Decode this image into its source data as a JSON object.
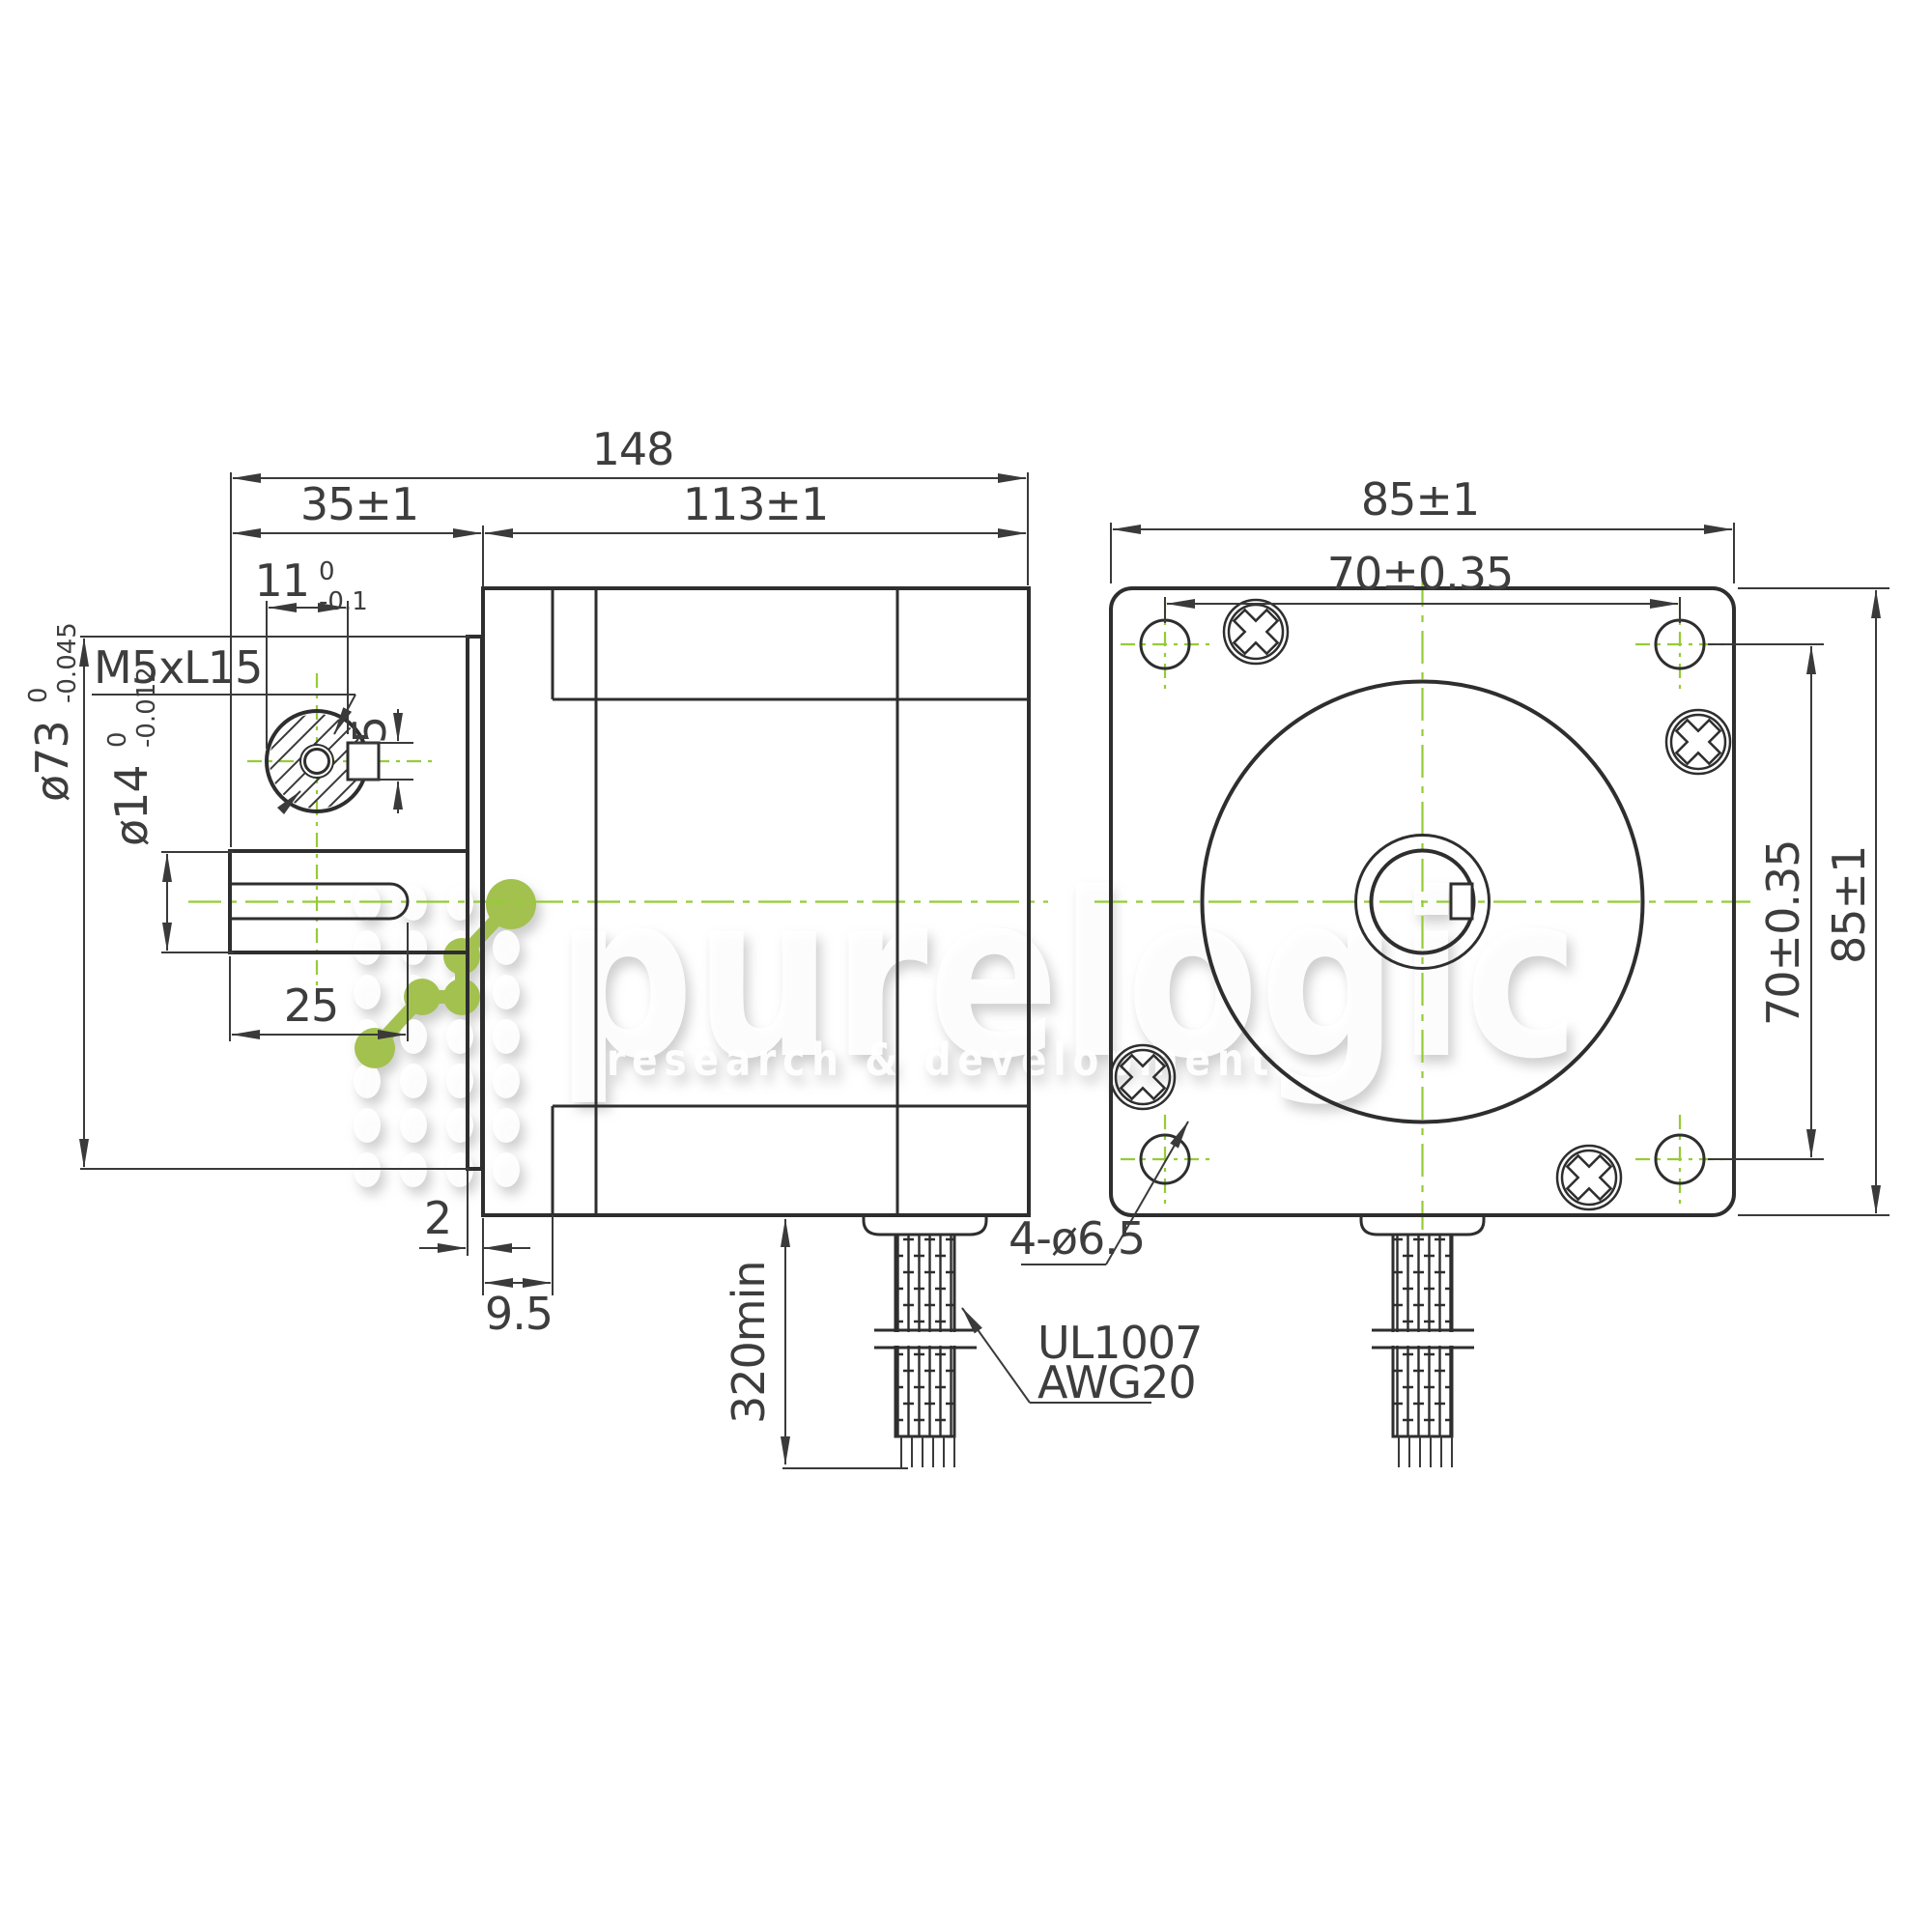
{
  "drawing": {
    "description": "Stepper motor dimensional drawing, side view and front view",
    "accent_green": "#a3c14f",
    "centerline_green": "#94cc35",
    "line_color": "#2e2e2e",
    "text_color": "#3d3d3d"
  },
  "watermark": {
    "word": "purelogic",
    "tagline": "research & development"
  },
  "side_view": {
    "overall_length": "148",
    "front_length": "35±1",
    "body_length": "113±1",
    "flat_width": "11",
    "flat_width_tol_upper": "0",
    "flat_width_tol_lower": "-0.1",
    "thread_callout": "M5xL15",
    "flat_depth": "5",
    "pilot_dia": "ø73",
    "pilot_dia_tol_upper": "0",
    "pilot_dia_tol_lower": "-0.045",
    "shaft_dia": "ø14",
    "shaft_dia_tol_upper": "0",
    "shaft_dia_tol_lower": "-0.012",
    "flat_length": "25",
    "pilot_height": "2",
    "front_step": "9.5",
    "cable_length": "320min",
    "cable_spec_1": "UL1007",
    "cable_spec_2": "AWG20"
  },
  "front_view": {
    "width": "85±1",
    "bolt_spacing_horizontal": "70±0.35",
    "bolt_spacing_vertical": "70±0.35",
    "height": "85±1",
    "mounting_holes": "4-ø6.5"
  }
}
